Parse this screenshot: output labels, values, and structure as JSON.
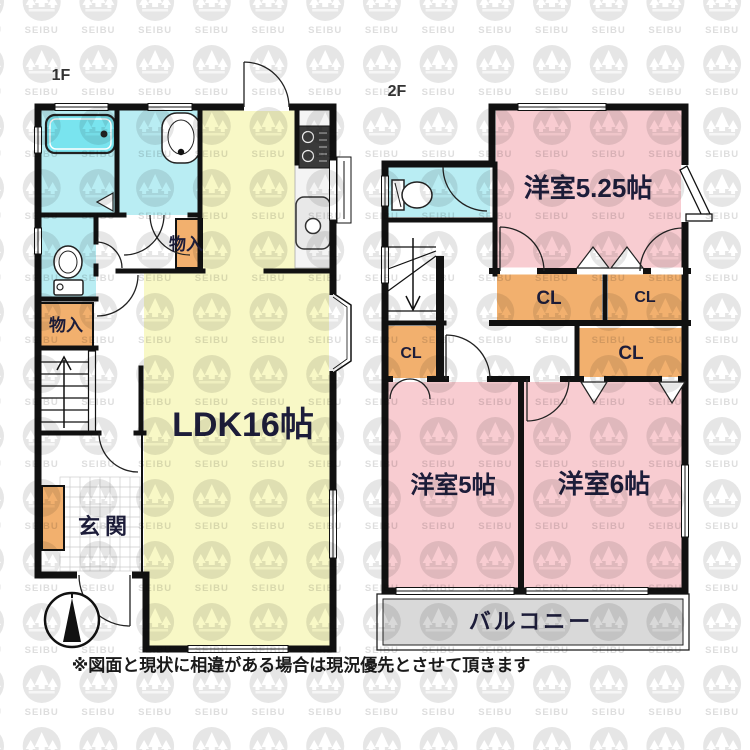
{
  "page": {
    "caption": "※図面と現状に相違がある場合は現況優先とさせて頂きます"
  },
  "watermark": {
    "text": "SEIBU"
  },
  "colors": {
    "wall": "#111111",
    "ldk_yellow": "#f8f8c6",
    "bedroom_pink": "#f8ccd1",
    "wet_cyan": "#b9edf3",
    "storage_orange": "#f2b06e",
    "balcony_gray": "#d9d9d9",
    "bathtub_cyan": "#79e4ef",
    "label_navy": "#1d1d3a",
    "watermark_gray": "#e6e6e6"
  },
  "floor1": {
    "label": "1F",
    "rooms": {
      "ldk": "LDK16帖",
      "entrance": "玄関",
      "storage_hall": "物入",
      "storage_left": "物入"
    }
  },
  "floor2": {
    "label": "2F",
    "rooms": {
      "bedroom_525": "洋室5.25帖",
      "bedroom_5": "洋室5帖",
      "bedroom_6": "洋室6帖",
      "closet_big": "CL",
      "closet_right": "CL",
      "closet_low": "CL",
      "closet_left": "CL",
      "balcony": "バルコニー"
    }
  }
}
